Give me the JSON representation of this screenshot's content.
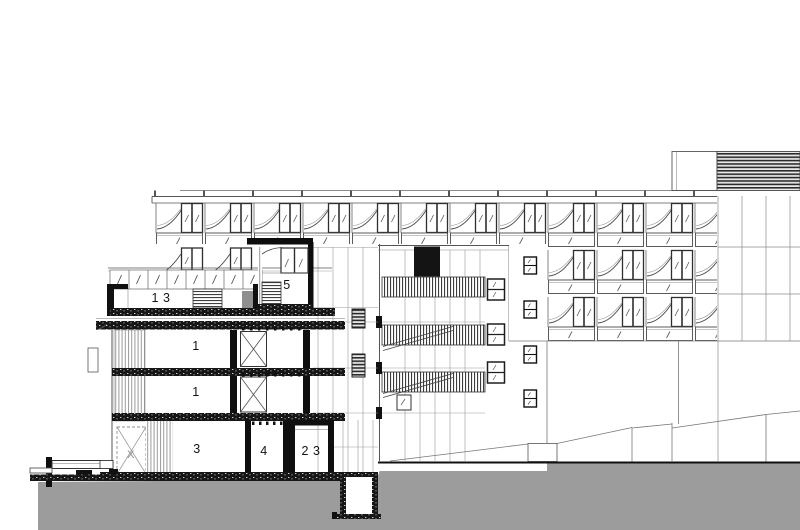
{
  "page": {
    "background": "#ffffff"
  },
  "drawing": {
    "type": "architectural-building-section-and-elevation",
    "colors": {
      "ground_fill": "#9c9c9c",
      "linework": "#555555",
      "cut_poche": "#111111",
      "background": "#ffffff"
    },
    "room_labels": [
      {
        "id": "upper-level-left",
        "text": "1 3"
      },
      {
        "id": "upper-level-mid",
        "text": "5"
      },
      {
        "id": "mid-level-upper",
        "text": "1"
      },
      {
        "id": "mid-level-lower",
        "text": "1"
      },
      {
        "id": "ground-level-left",
        "text": "3"
      },
      {
        "id": "ground-level-mid",
        "text": "4"
      },
      {
        "id": "ground-level-right",
        "text": "2 3"
      },
      {
        "id": "elevator-shaft",
        "text": "X"
      }
    ]
  }
}
